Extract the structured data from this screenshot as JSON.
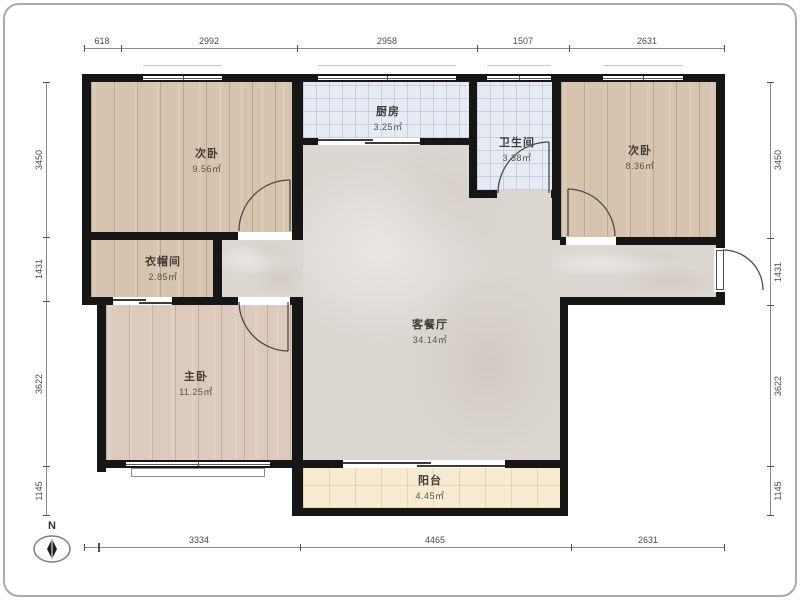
{
  "title": "apartment-floor-plan",
  "compass": {
    "label": "N"
  },
  "rooms": [
    {
      "id": "bedroom-top-left",
      "name": "次卧",
      "area": "9.56㎡"
    },
    {
      "id": "kitchen",
      "name": "厨房",
      "area": "3.25㎡"
    },
    {
      "id": "bathroom",
      "name": "卫生间",
      "area": "3.38㎡"
    },
    {
      "id": "bedroom-top-right",
      "name": "次卧",
      "area": "8.36㎡"
    },
    {
      "id": "cloakroom",
      "name": "衣帽间",
      "area": "2.85㎡"
    },
    {
      "id": "living-dining",
      "name": "客餐厅",
      "area": "34.14㎡"
    },
    {
      "id": "master-bedroom",
      "name": "主卧",
      "area": "11.25㎡"
    },
    {
      "id": "balcony",
      "name": "阳台",
      "area": "4.45㎡"
    }
  ],
  "dimensions": {
    "top": [
      "618",
      "2992",
      "2958",
      "1507",
      "2631"
    ],
    "bottom": [
      "3334",
      "4465",
      "2631"
    ],
    "left": [
      "3450",
      "1431",
      "3622",
      "1145"
    ],
    "right": [
      "3450",
      "1431",
      "3622",
      "1145"
    ]
  },
  "colors": {
    "wall": "#161616",
    "wood_floor": "#d7c4ae",
    "tile_floor": "#e5eaf3",
    "living_floor": "#dcd7d1",
    "balcony_floor": "#f7ecd1"
  }
}
